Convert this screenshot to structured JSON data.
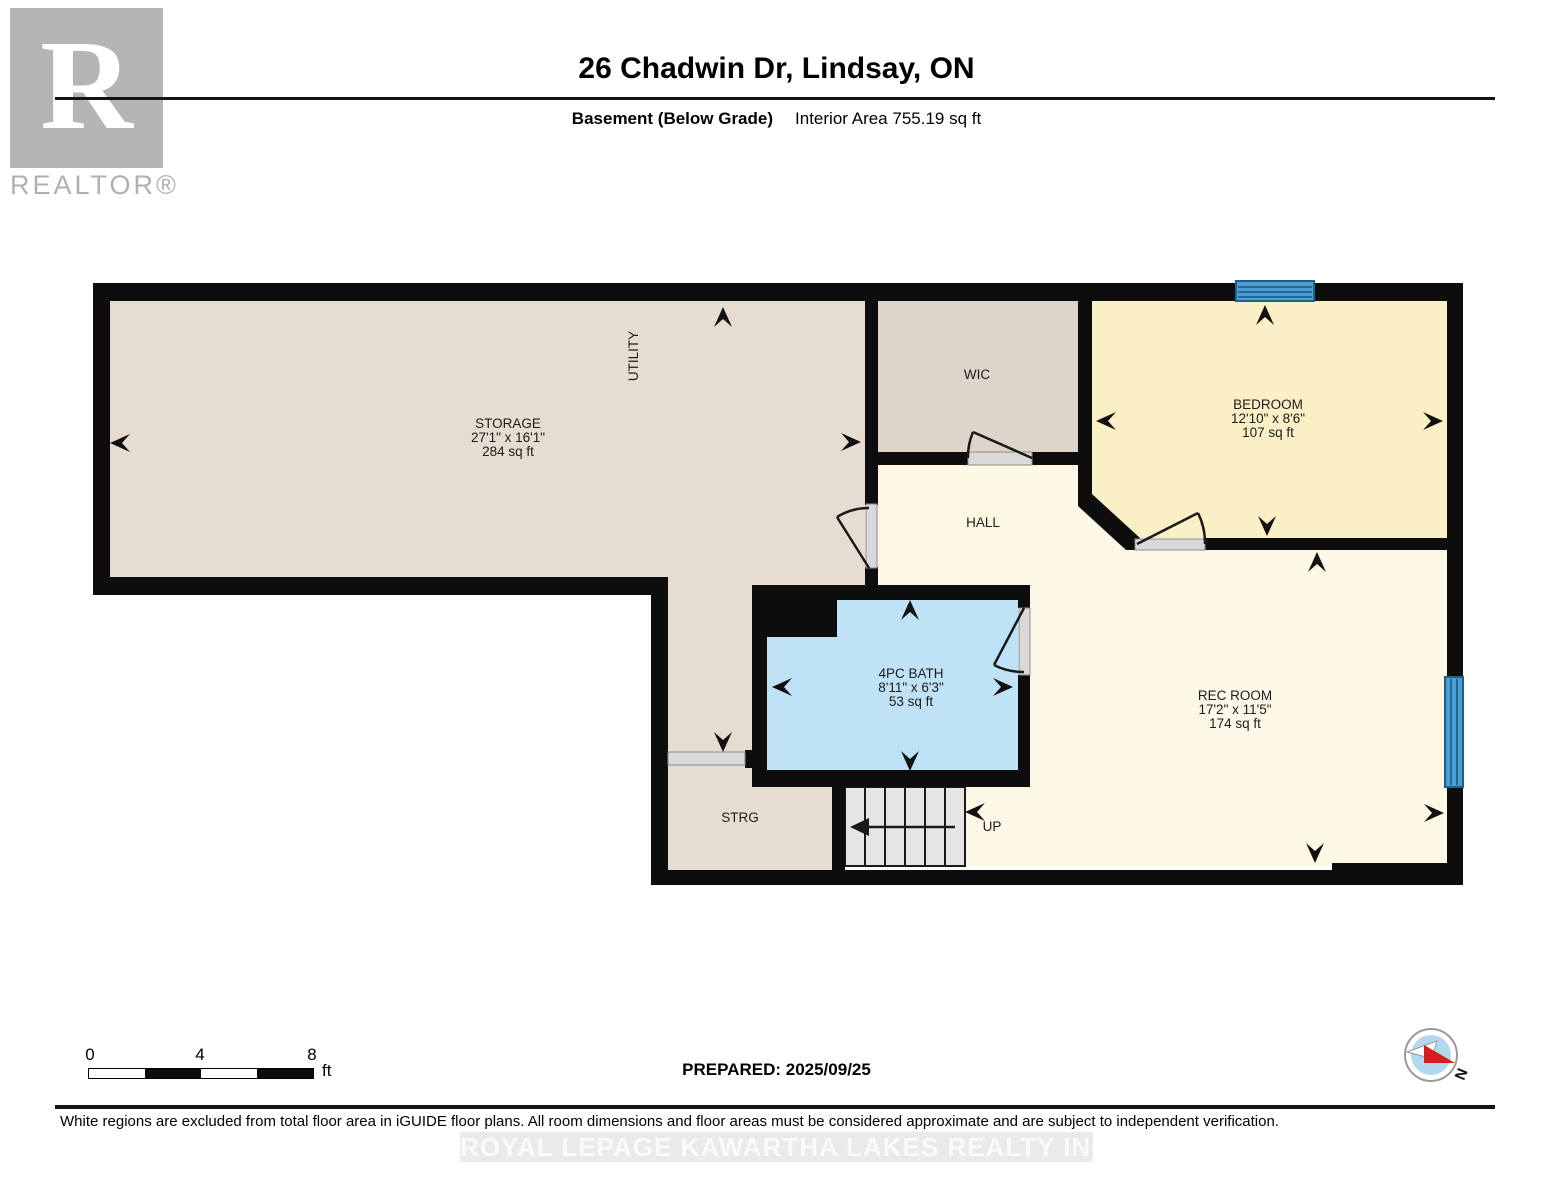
{
  "header": {
    "title": "26 Chadwin Dr, Lindsay, ON",
    "floor_label": "Basement (Below Grade)",
    "area_label": "Interior Area 755.19 sq ft"
  },
  "branding": {
    "logo_letter": "R",
    "logo_word": "REALTOR®",
    "watermark": "ROYAL LEPAGE KAWARTHA LAKES REALTY INC., Brokerage"
  },
  "rooms": {
    "storage": {
      "name": "STORAGE",
      "dims": "27'1\" x 16'1\"",
      "area": "284 sq ft"
    },
    "utility": {
      "name": "UTILITY"
    },
    "wic": {
      "name": "WIC"
    },
    "bedroom": {
      "name": "BEDROOM",
      "dims": "12'10\" x 8'6\"",
      "area": "107 sq ft"
    },
    "hall": {
      "name": "HALL"
    },
    "bath": {
      "name": "4PC BATH",
      "dims": "8'11\" x 6'3\"",
      "area": "53 sq ft"
    },
    "rec_room": {
      "name": "REC ROOM",
      "dims": "17'2\" x 11'5\"",
      "area": "174 sq ft"
    },
    "strg": {
      "name": "STRG"
    },
    "stairs": {
      "label": "UP"
    }
  },
  "scale_bar": {
    "tick0": "0",
    "tick1": "4",
    "tick2": "8",
    "unit": "ft"
  },
  "footer": {
    "prepared": "PREPARED: 2025/09/25",
    "disclaimer": "White regions are excluded from total floor area in iGUIDE floor plans. All room dimensions and floor areas must be considered approximate and are subject to independent verification.",
    "compass_label": "N"
  },
  "colors": {
    "wall": "#0d0d0d",
    "storage_fill": "#e6ddd0",
    "wic_fill": "#ded4c9",
    "bedroom_fill": "#faefc5",
    "hall_fill": "#fdf8e6",
    "bath_fill": "#bfe2f6",
    "stairs_fill": "#e5e5e5",
    "window_blue": "#4d9fd3",
    "window_frame": "#1f618d",
    "compass_red": "#d61d1d",
    "logo_gray": "#b5b5b5"
  }
}
